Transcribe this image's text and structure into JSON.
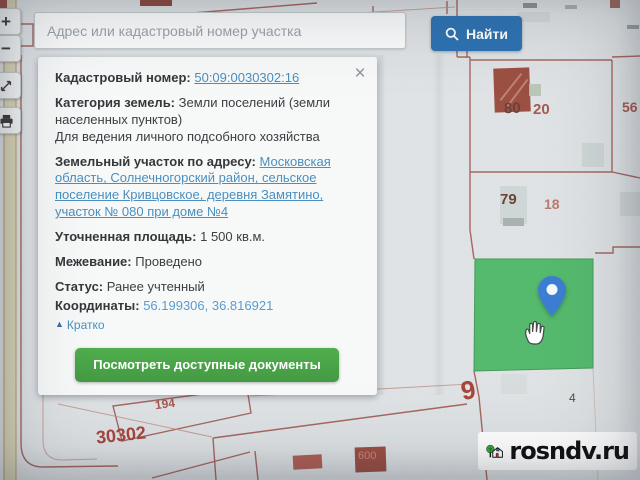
{
  "search": {
    "placeholder": "Адрес или кадастровый номер участка",
    "button": "Найти"
  },
  "toolbar": {
    "zoom_in": "+",
    "zoom_out": "−"
  },
  "panel": {
    "close": "×",
    "cadastral_label": "Кадастровый номер:",
    "cadastral_value": "50:09:0030302:16",
    "category_label": "Категория земель:",
    "category_value": "Земли поселений (земли населенных пунктов)",
    "category_usage": "Для ведения личного подсобного хозяйства",
    "address_label": "Земельный участок по адресу:",
    "address_value": "Московская область, Солнечногорский район, сельское поселение Кривцовское, деревня Замятино, участок № 080 при доме №4",
    "area_label": "Уточненная площадь:",
    "area_value": "1 500 кв.м.",
    "survey_label": "Межевание:",
    "survey_value": "Проведено",
    "status_label": "Статус:",
    "status_value": "Ранее учтенный",
    "coords_label": "Координаты:",
    "coords_value": "56.199306, 36.816921",
    "collapse_icon": "▲",
    "collapse_label": "Кратко",
    "documents_button": "Посмотреть доступные документы"
  },
  "map": {
    "labels": {
      "l80": "80",
      "l20": "20",
      "l56": "56",
      "l79": "79",
      "l18": "18",
      "l9": "9",
      "l4": "4",
      "l194": "194",
      "l30302": "30302",
      "l30302s": "30302",
      "l600": "600"
    },
    "watermark": "rosndv.ru"
  },
  "colors": {
    "accent_blue": "#2e73b3",
    "link_blue": "#4a8fc0",
    "button_green": "#46a245",
    "parcel_green": "#55ba6d",
    "pin_blue": "#3d7ed3",
    "boundary_red": "#a05a52"
  }
}
